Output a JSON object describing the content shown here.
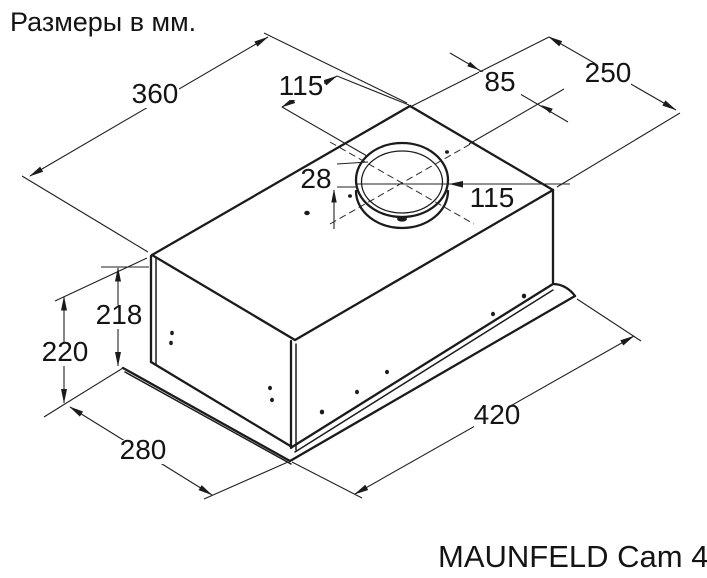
{
  "title": "Размеры в мм.",
  "product": "MAUNFELD Cam 45",
  "units": "мм",
  "dims": {
    "top_width": "360",
    "duct_offset_x": "115",
    "duct_offset_y": "85",
    "top_depth": "250",
    "collar_height": "28",
    "duct_diameter": "115",
    "body_height": "218",
    "overall_height": "220",
    "bottom_depth": "280",
    "bottom_width": "420"
  },
  "colors": {
    "ink": "#1b1b1b",
    "paper": "#ffffff"
  }
}
